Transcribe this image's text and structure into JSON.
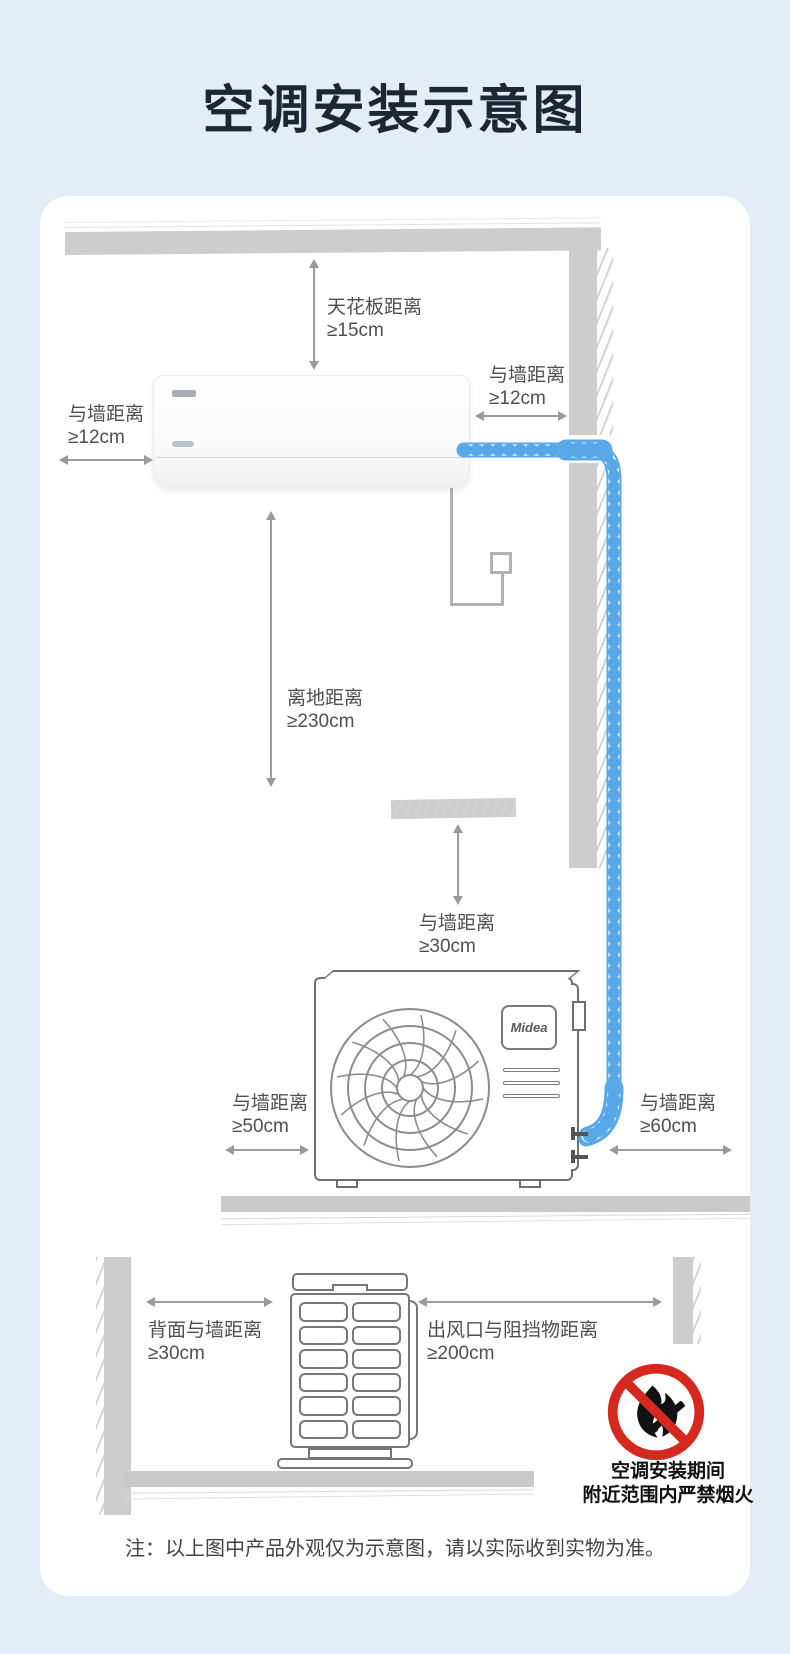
{
  "page": {
    "title": "空调安装示意图",
    "note": "注：以上图中产品外观仅为示意图，请以实际收到实物为准。"
  },
  "brand": "Midea",
  "scene_indoor": {
    "labels": {
      "ceiling": {
        "line1": "天花板距离",
        "line2": "≥15cm"
      },
      "wall_right": {
        "line1": "与墙距离",
        "line2": "≥12cm"
      },
      "wall_left": {
        "line1": "与墙距离",
        "line2": "≥12cm"
      },
      "floor": {
        "line1": "离地距离",
        "line2": "≥230cm"
      }
    }
  },
  "scene_outdoor": {
    "labels": {
      "wall_top": {
        "line1": "与墙距离",
        "line2": "≥30cm"
      },
      "wall_left": {
        "line1": "与墙距离",
        "line2": "≥50cm"
      },
      "wall_right": {
        "line1": "与墙距离",
        "line2": "≥60cm"
      }
    }
  },
  "scene_topview": {
    "labels": {
      "back_wall": {
        "line1": "背面与墙距离",
        "line2": "≥30cm"
      },
      "outlet": {
        "line1": "出风口与阻挡物距离",
        "line2": "≥200cm"
      }
    },
    "warning": {
      "line1": "空调安装期间",
      "line2": "附近范围内严禁烟火"
    }
  },
  "icons": {
    "no_open_flame": "prohibition-circle-with-flame-and-match",
    "measure_arrows": "double-headed-arrow"
  },
  "colors": {
    "background": "#e4edf7",
    "card": "#ffffff",
    "title_text": "#1c2736",
    "label_text": "#4f4f4f",
    "structure_gray": "#cdcdcd",
    "pipe_blue": "#57a7e9",
    "prohibition_red": "#d5281e"
  }
}
